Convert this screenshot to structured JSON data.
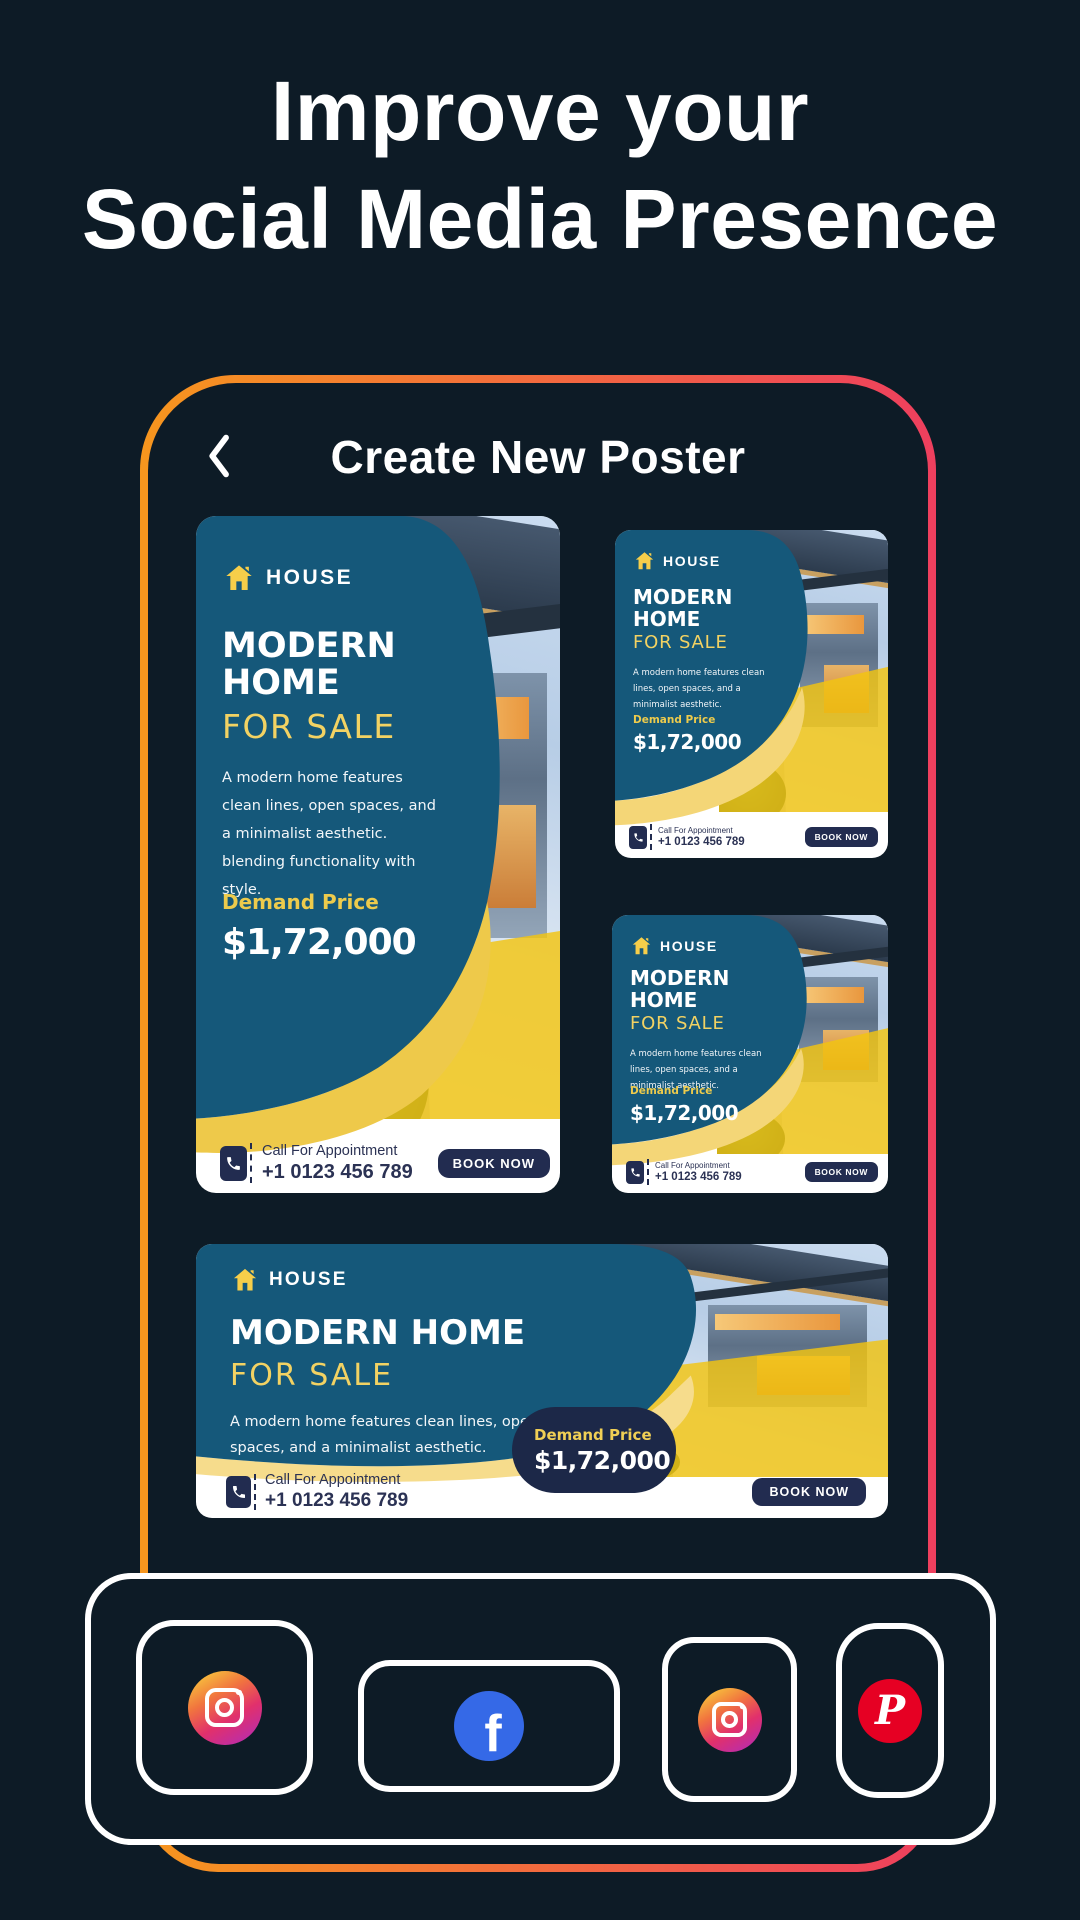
{
  "hero": {
    "title_line1": "Improve your",
    "title_line2": "Social Media Presence"
  },
  "screen": {
    "back_icon": "chevron-left-icon",
    "title": "Create New Poster"
  },
  "poster": {
    "brand": "HOUSE",
    "title_line1": "MODERN",
    "title_line2": "HOME",
    "title_single_line": "MODERN HOME",
    "subtitle": "FOR SALE",
    "description_long": "A modern home features clean lines, open spaces, and a minimalist aesthetic. blending functionality with style.",
    "description_short": "A modern home features clean lines, open spaces, and a minimalist aesthetic.",
    "price_label": "Demand Price",
    "price_value": "$1,72,000",
    "call_label": "Call For Appointment",
    "phone_number": "+1 0123 456 789",
    "book_button": "BOOK NOW"
  },
  "social": {
    "icons": [
      {
        "name": "instagram-icon"
      },
      {
        "name": "facebook-icon",
        "glyph": "f"
      },
      {
        "name": "instagram-icon"
      },
      {
        "name": "pinterest-icon",
        "glyph": "P"
      }
    ]
  },
  "colors": {
    "background": "#0d1b26",
    "frame_gradient_start": "#f6961e",
    "frame_gradient_end": "#ee3f5e",
    "poster_teal": "#15587a",
    "poster_yellow": "#f2d263",
    "poster_gold": "#eec94a",
    "navy": "#222c50",
    "facebook_blue": "#3569e7",
    "pinterest_red": "#e60023"
  }
}
